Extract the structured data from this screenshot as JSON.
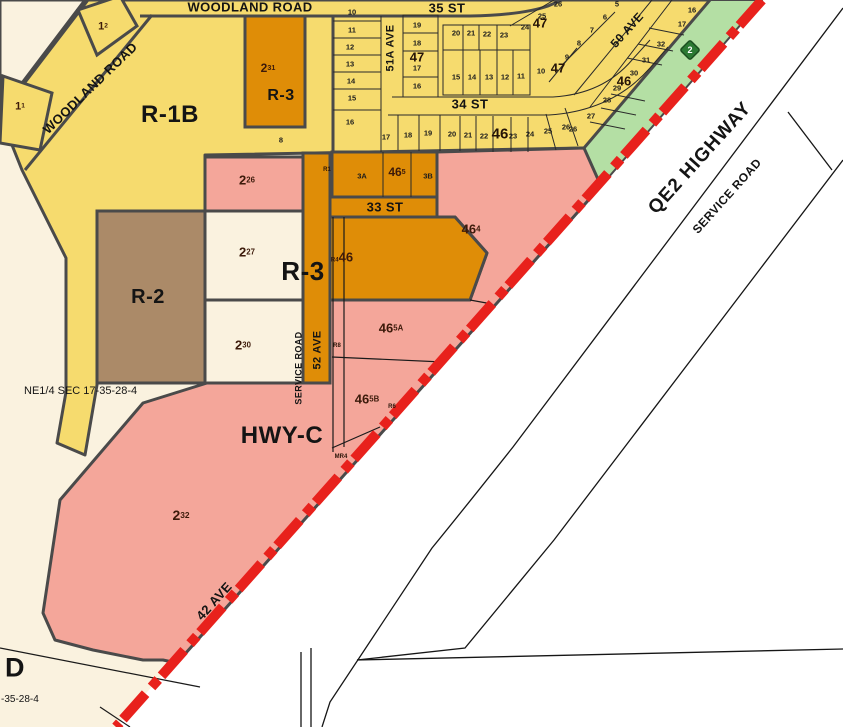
{
  "colors": {
    "cream": "#faf2df",
    "white": "#ffffff",
    "yellow": "#f6db6e",
    "orange": "#df8d07",
    "pink": "#f4a69a",
    "brown": "#ab8a68",
    "green_strip": "#b4dfa4",
    "red_highway": "#e8211c",
    "outline": "#4a4a4a",
    "shield_green": "#2c7a33"
  },
  "map": {
    "streets": {
      "woodland_road_top": "WOODLAND ROAD",
      "woodland_road_diag": "WOODLAND ROAD",
      "st35": "35 ST",
      "st34": "34 ST",
      "st33": "33 ST",
      "ave51a": "51A AVE",
      "ave50": "50 AVE",
      "ave52": "52 AVE",
      "ave42": "42 AVE",
      "service_road_left": "SERVICE ROAD",
      "service_road_right": "SERVICE ROAD",
      "qe2": "QE2 HIGHWAY"
    },
    "zones": {
      "r1b": "R-1B",
      "r3_north": "R-3",
      "r3_main": "R-3",
      "r2": "R-2",
      "hwyc": "HWY-C",
      "d": "D"
    },
    "annotations": {
      "section": "NE1/4 SEC 17-35-28-4",
      "section_corner": "-35-28-4",
      "shield": "2"
    },
    "parcel_labels": [
      {
        "base": "1",
        "sup": "2",
        "x": 103,
        "y": 27,
        "size": 11
      },
      {
        "base": "1",
        "sup": "1",
        "x": 20,
        "y": 107,
        "size": 11
      },
      {
        "base": "2",
        "sup": "31",
        "x": 268,
        "y": 68,
        "size": 12
      },
      {
        "base": "2",
        "sup": "26",
        "x": 247,
        "y": 180,
        "size": 13
      },
      {
        "base": "2",
        "sup": "27",
        "x": 247,
        "y": 252,
        "size": 13
      },
      {
        "base": "2",
        "sup": "30",
        "x": 243,
        "y": 345,
        "size": 13
      },
      {
        "base": "2",
        "sup": "32",
        "x": 181,
        "y": 515,
        "size": 14
      },
      {
        "base": "46",
        "sup": "4",
        "x": 471,
        "y": 229,
        "size": 13
      },
      {
        "base": "46",
        "sup": "5A",
        "x": 391,
        "y": 328,
        "size": 13
      },
      {
        "base": "46",
        "sup": "5B",
        "x": 367,
        "y": 399,
        "size": 13
      },
      {
        "base": "46",
        "sup": "5",
        "x": 397,
        "y": 172,
        "size": 12
      },
      {
        "pre": "R4",
        "base": "46",
        "sup": "",
        "x": 342,
        "y": 257,
        "size": 13
      }
    ],
    "block_labels": [
      {
        "text": "47",
        "x": 417,
        "y": 57,
        "size": 13
      },
      {
        "text": "47",
        "x": 540,
        "y": 23,
        "size": 13
      },
      {
        "text": "47",
        "x": 558,
        "y": 68,
        "size": 13
      },
      {
        "text": "46",
        "x": 500,
        "y": 134,
        "size": 15
      },
      {
        "text": "46",
        "x": 624,
        "y": 81,
        "size": 13
      }
    ],
    "lot_numbers": [
      {
        "n": "10",
        "x": 352,
        "y": 12
      },
      {
        "n": "11",
        "x": 352,
        "y": 30
      },
      {
        "n": "12",
        "x": 350,
        "y": 47
      },
      {
        "n": "13",
        "x": 350,
        "y": 64
      },
      {
        "n": "14",
        "x": 351,
        "y": 81
      },
      {
        "n": "15",
        "x": 352,
        "y": 98
      },
      {
        "n": "16",
        "x": 350,
        "y": 122
      },
      {
        "n": "19",
        "x": 417,
        "y": 25
      },
      {
        "n": "18",
        "x": 417,
        "y": 43
      },
      {
        "n": "17",
        "x": 417,
        "y": 68
      },
      {
        "n": "16",
        "x": 417,
        "y": 86
      },
      {
        "n": "20",
        "x": 456,
        "y": 33
      },
      {
        "n": "21",
        "x": 471,
        "y": 33
      },
      {
        "n": "22",
        "x": 487,
        "y": 34
      },
      {
        "n": "23",
        "x": 504,
        "y": 35
      },
      {
        "n": "24",
        "x": 525,
        "y": 27
      },
      {
        "n": "25",
        "x": 542,
        "y": 16
      },
      {
        "n": "26",
        "x": 558,
        "y": 4
      },
      {
        "n": "15",
        "x": 456,
        "y": 77
      },
      {
        "n": "14",
        "x": 472,
        "y": 77
      },
      {
        "n": "13",
        "x": 489,
        "y": 77
      },
      {
        "n": "12",
        "x": 505,
        "y": 77
      },
      {
        "n": "11",
        "x": 521,
        "y": 76
      },
      {
        "n": "10",
        "x": 541,
        "y": 71
      },
      {
        "n": "9",
        "x": 567,
        "y": 57
      },
      {
        "n": "5",
        "x": 617,
        "y": 4
      },
      {
        "n": "6",
        "x": 605,
        "y": 17
      },
      {
        "n": "7",
        "x": 592,
        "y": 30
      },
      {
        "n": "8",
        "x": 579,
        "y": 43
      },
      {
        "n": "17",
        "x": 386,
        "y": 137
      },
      {
        "n": "18",
        "x": 408,
        "y": 135
      },
      {
        "n": "19",
        "x": 428,
        "y": 133
      },
      {
        "n": "20",
        "x": 452,
        "y": 134
      },
      {
        "n": "21",
        "x": 468,
        "y": 135
      },
      {
        "n": "22",
        "x": 484,
        "y": 136
      },
      {
        "n": "23",
        "x": 513,
        "y": 136
      },
      {
        "n": "24",
        "x": 530,
        "y": 134
      },
      {
        "n": "25",
        "x": 548,
        "y": 131
      },
      {
        "n": "26",
        "x": 566,
        "y": 127
      },
      {
        "n": "16",
        "x": 692,
        "y": 10
      },
      {
        "n": "17",
        "x": 682,
        "y": 24
      },
      {
        "n": "32",
        "x": 661,
        "y": 44
      },
      {
        "n": "31",
        "x": 646,
        "y": 60
      },
      {
        "n": "30",
        "x": 634,
        "y": 73
      },
      {
        "n": "29",
        "x": 617,
        "y": 88
      },
      {
        "n": "28",
        "x": 607,
        "y": 100
      },
      {
        "n": "27",
        "x": 591,
        "y": 116
      },
      {
        "n": "26",
        "x": 573,
        "y": 129
      },
      {
        "n": "8",
        "x": 281,
        "y": 140
      },
      {
        "n": "3A",
        "x": 362,
        "y": 176
      },
      {
        "n": "3B",
        "x": 428,
        "y": 176
      }
    ],
    "tiny_labels": [
      {
        "t": "R1",
        "x": 327,
        "y": 170
      },
      {
        "t": "R8",
        "x": 337,
        "y": 346
      },
      {
        "t": "R6",
        "x": 392,
        "y": 407
      },
      {
        "t": "MR4",
        "x": 341,
        "y": 457
      }
    ]
  }
}
